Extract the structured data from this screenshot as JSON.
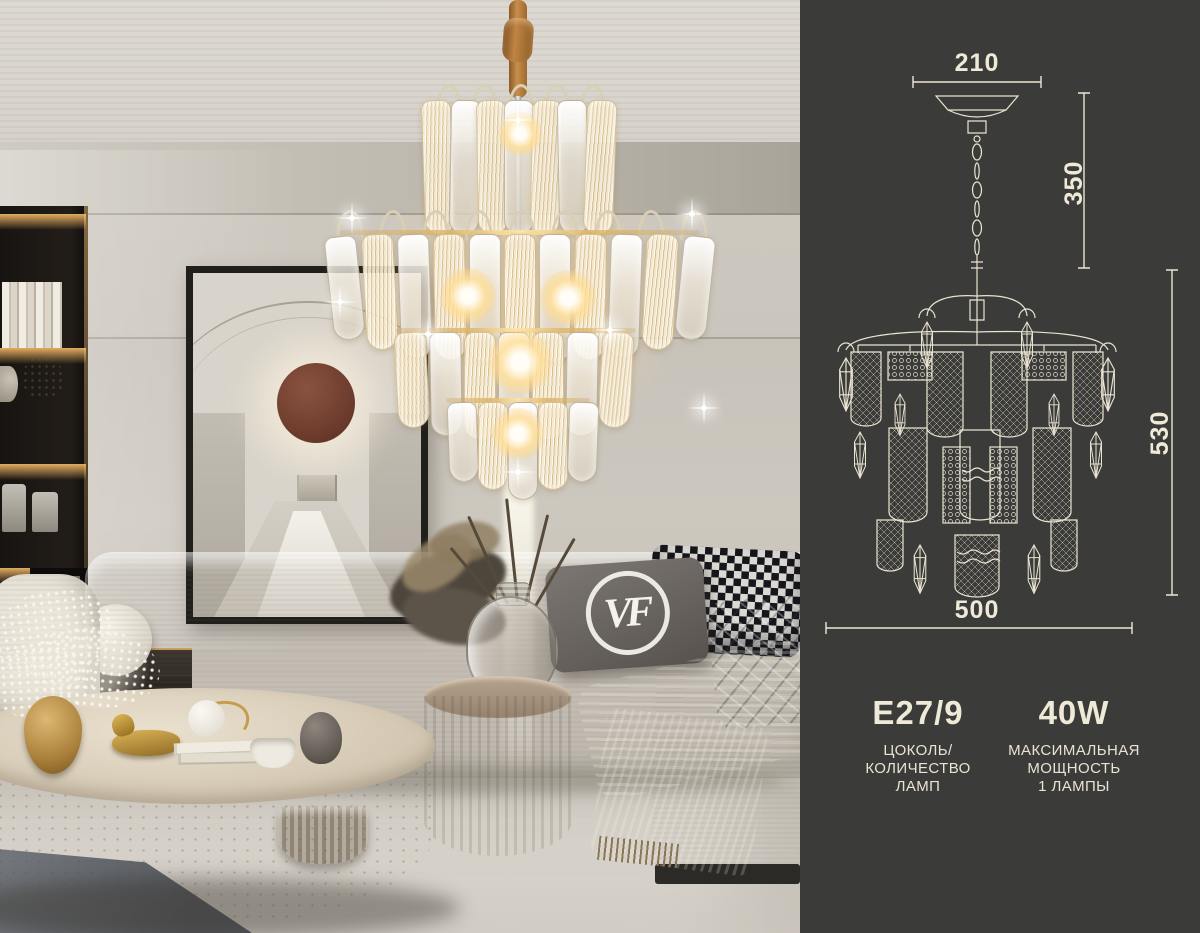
{
  "panel": {
    "dimensions": {
      "top_width": "210",
      "chain_height": "350",
      "body_height": "530",
      "bottom_width": "500"
    },
    "specs": {
      "socket": {
        "value": "E27/9",
        "caption_lines": [
          "ЦОКОЛЬ/",
          "КОЛИЧЕСТВО",
          "ЛАМП"
        ]
      },
      "power": {
        "value": "40W",
        "caption_lines": [
          "МАКСИМАЛЬНАЯ",
          "МОЩНОСТЬ",
          "1 ЛАМПЫ"
        ]
      }
    }
  },
  "photo": {
    "pillow_monogram": "VF"
  },
  "colors": {
    "panel_background": "#3b3b39",
    "panel_ink": "#ece6d4",
    "gold_accent": "#c49a4e",
    "wall": "#cbc6bd",
    "sofa": "#e6e1d7",
    "throw": "#a18a63",
    "rug": "#5f636a",
    "stone_table": "#cfc3ae",
    "wood_table": "#8b7866",
    "artwork_sphere": "#7b4634",
    "cord": "#c08045"
  }
}
